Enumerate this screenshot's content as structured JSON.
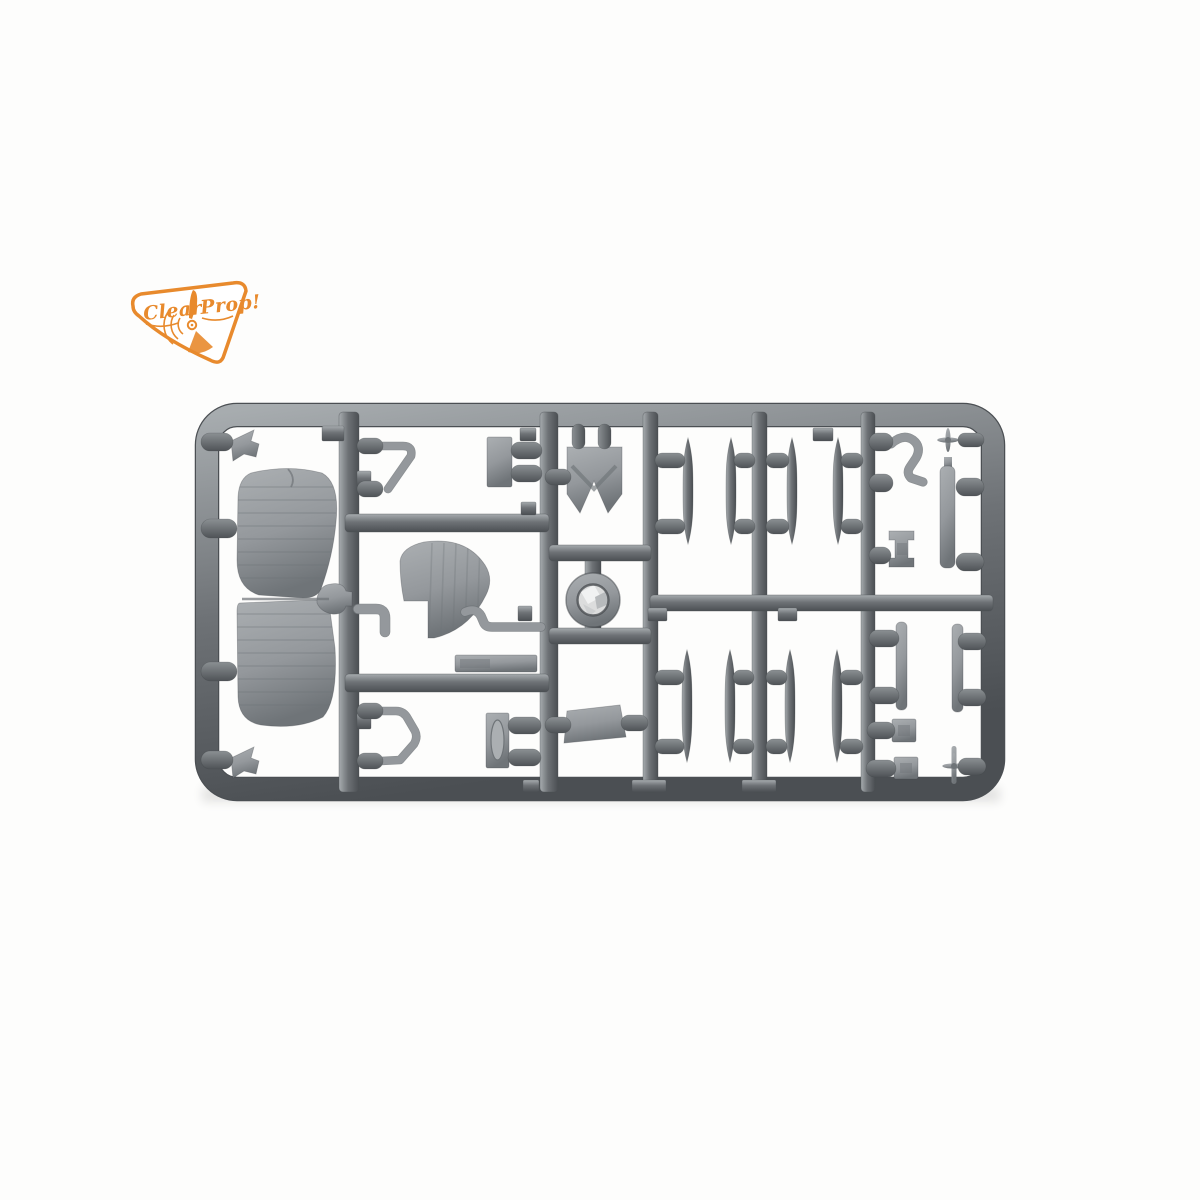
{
  "logo": {
    "brand": "Clear Prop!",
    "word1": "Clear",
    "word2": "Prop!",
    "orange": "#e88a2d"
  },
  "palette": {
    "bg": "#fdfdfc",
    "runner_hi": "#a7acaf",
    "runner_mid": "#6e7276",
    "runner_lo": "#4b4f53",
    "part_hi": "#abafb2",
    "part_mid": "#94989c",
    "part_lo": "#6f7478",
    "gate_hi": "#8b9093",
    "gate_lo": "#4f5357",
    "shine": "#dcdddd",
    "outline": "#3f4347"
  },
  "sprue": {
    "frame": {
      "x": 207,
      "y": 415,
      "w": 786,
      "h": 374,
      "r": 30,
      "t": 22
    },
    "v_runners": [
      [
        339,
        412,
        20,
        380
      ],
      [
        540,
        412,
        18,
        380
      ],
      [
        643,
        412,
        15,
        380
      ],
      [
        752,
        412,
        15,
        380
      ],
      [
        861,
        412,
        14,
        380
      ],
      [
        585,
        548,
        16,
        90
      ]
    ],
    "h_runners": [
      [
        345,
        514,
        204,
        18
      ],
      [
        345,
        674,
        204,
        18
      ],
      [
        549,
        545,
        102,
        16
      ],
      [
        549,
        628,
        102,
        16
      ],
      [
        650,
        595,
        343,
        16
      ]
    ],
    "tabs": [
      [
        322,
        426,
        22,
        15
      ],
      [
        357,
        471,
        14,
        16
      ],
      [
        520,
        428,
        16,
        13
      ],
      [
        521,
        502,
        15,
        13
      ],
      [
        813,
        428,
        20,
        13
      ],
      [
        648,
        608,
        19,
        13
      ],
      [
        778,
        608,
        19,
        13
      ],
      [
        632,
        780,
        34,
        12
      ],
      [
        742,
        780,
        34,
        12
      ],
      [
        523,
        780,
        16,
        12
      ],
      [
        357,
        713,
        14,
        16
      ],
      [
        518,
        606,
        14,
        15
      ]
    ],
    "struts": [
      [
        688,
        438,
        544
      ],
      [
        731,
        438,
        544
      ],
      [
        792,
        438,
        544
      ],
      [
        838,
        438,
        544
      ],
      [
        687,
        650,
        762
      ],
      [
        730,
        650,
        762
      ],
      [
        790,
        650,
        762
      ],
      [
        837,
        650,
        762
      ]
    ],
    "strut_half_width": 5,
    "gates": [
      [
        201,
        433,
        32,
        18
      ],
      [
        201,
        519,
        36,
        19
      ],
      [
        201,
        662,
        36,
        19
      ],
      [
        201,
        751,
        32,
        18
      ],
      [
        357,
        438,
        26,
        16
      ],
      [
        357,
        481,
        26,
        16
      ],
      [
        357,
        703,
        26,
        16
      ],
      [
        357,
        753,
        26,
        16
      ],
      [
        511,
        442,
        31,
        17
      ],
      [
        511,
        465,
        31,
        17
      ],
      [
        508,
        717,
        33,
        17
      ],
      [
        508,
        749,
        33,
        17
      ],
      [
        545,
        469,
        26,
        16
      ],
      [
        545,
        717,
        26,
        16
      ],
      [
        621,
        715,
        27,
        16
      ],
      [
        572,
        424,
        13,
        25
      ],
      [
        598,
        424,
        13,
        25
      ],
      [
        655,
        453,
        30,
        15
      ],
      [
        655,
        519,
        30,
        15
      ],
      [
        734,
        453,
        21,
        15
      ],
      [
        734,
        519,
        21,
        15
      ],
      [
        766,
        453,
        23,
        15
      ],
      [
        766,
        519,
        23,
        15
      ],
      [
        841,
        453,
        22,
        15
      ],
      [
        841,
        519,
        22,
        15
      ],
      [
        655,
        670,
        29,
        15
      ],
      [
        655,
        739,
        29,
        15
      ],
      [
        733,
        670,
        21,
        15
      ],
      [
        733,
        739,
        21,
        15
      ],
      [
        766,
        670,
        21,
        15
      ],
      [
        766,
        739,
        21,
        15
      ],
      [
        840,
        670,
        23,
        15
      ],
      [
        840,
        739,
        23,
        15
      ],
      [
        869,
        433,
        24,
        18
      ],
      [
        869,
        474,
        24,
        18
      ],
      [
        869,
        547,
        22,
        17
      ],
      [
        869,
        630,
        30,
        17
      ],
      [
        869,
        687,
        30,
        17
      ],
      [
        867,
        722,
        28,
        17
      ],
      [
        866,
        760,
        30,
        17
      ],
      [
        958,
        433,
        26,
        14
      ],
      [
        956,
        478,
        28,
        18
      ],
      [
        956,
        553,
        28,
        18
      ],
      [
        958,
        633,
        28,
        17
      ],
      [
        958,
        689,
        28,
        17
      ],
      [
        958,
        758,
        28,
        17
      ]
    ],
    "parts": [
      {
        "name": "upper-wing-part",
        "kind": "wing",
        "d": "M251,473 Q239,478 238,497 L237,560 Q237,588 259,595 L303,598 Q317,598 321,589 Q333,556 336,522 Q340,483 322,473 Q288,464 251,473 Z",
        "ribs": {
          "x1": 238,
          "x2": 336,
          "y0": 487,
          "step": 13,
          "n": 8
        },
        "crack": "M288,469 Q296,478 291,487"
      },
      {
        "name": "lower-wing-part",
        "kind": "wing",
        "d": "M240,603 L316,600 Q328,600 330,611 L335,648 Q338,700 323,717 Q298,730 261,725 Q239,721 238,697 L237,612 Q237,603 240,603 Z",
        "ribs": {
          "x1": 237,
          "x2": 336,
          "y0": 614,
          "step": 13,
          "n": 8
        }
      },
      {
        "name": "wing-joint-connector",
        "kind": "path",
        "d": "M317,598 Q320,585 331,584 Q343,582 346,591 L352,592 L352,606 L346,606 Q343,615 332,614 Q321,612 317,603 Z"
      },
      {
        "name": "wing-seam",
        "kind": "line",
        "x1": 242,
        "y1": 599,
        "x2": 329,
        "y2": 599,
        "w": 2.4,
        "opacity": 0.7
      },
      {
        "name": "pennant-part-top",
        "kind": "path",
        "d": "M231,441 L254,430 L251,441 L259,444 L256,457 L244,454 L233,461 Z"
      },
      {
        "name": "pennant-part-bottom",
        "kind": "path",
        "d": "M231,758 L254,747 L251,758 L259,761 L256,774 L244,771 L233,778 Z"
      },
      {
        "name": "windscreen-frame-part-top",
        "kind": "stroke",
        "d": "M381,446 L403,446 Q413,446 411,456 L388,489",
        "w": 7
      },
      {
        "name": "small-plate-part",
        "kind": "rect",
        "x": 487,
        "y": 437,
        "wd": 25,
        "ht": 50,
        "rx": 2
      },
      {
        "name": "tail-fin-part",
        "kind": "fin",
        "d": "M400,561 Q402,547 424,542 Q466,536 485,565 Q494,579 486,595 Q469,630 434,638 L428,638 L428,601 L404,601 Q400,581 400,561 Z",
        "ribs": {
          "x0": 432,
          "step": 12,
          "n": 5,
          "y1": 543,
          "y2": 636
        }
      },
      {
        "name": "bent-rod-part-left",
        "kind": "stroke",
        "d": "M358,609 L376,609 Q385,609 385,618 L385,632",
        "w": 9
      },
      {
        "name": "bent-rod-part-right",
        "kind": "stroke",
        "d": "M465,612 Q476,607 481,616 L484,623 Q486,627 492,627 L541,627",
        "w": 8
      },
      {
        "name": "strip-part-a",
        "kind": "rect",
        "x": 455,
        "y": 655,
        "wd": 82,
        "ht": 17,
        "rx": 2,
        "inner": [
          460,
          659,
          30,
          9
        ]
      },
      {
        "name": "windscreen-frame-part-bottom",
        "kind": "stroke",
        "d": "M381,711 L396,711 Q404,711 408,719 L415,731 Q418,737 414,744 L400,760 L381,761",
        "w": 7
      },
      {
        "name": "headrest-plate-part",
        "kind": "rect",
        "x": 486,
        "y": 713,
        "wd": 23,
        "ht": 55,
        "rx": 2,
        "oval": [
          497.5,
          740,
          6.5,
          20
        ]
      },
      {
        "name": "fuselage-deck-part",
        "kind": "path",
        "d": "M567,447 L622,447 L622,494 L608,513 L594,481 L580,513 L567,494 Z",
        "chevron": "M572,466 L594,489 L616,466"
      },
      {
        "name": "cowl-ring-part",
        "kind": "ring",
        "cx": 593,
        "cy": 600,
        "ro": 27,
        "ri": 15.5,
        "facets": [
          {
            "pts": "581,592 594,585 601,597 588,604",
            "c": "#f1f2f2"
          },
          {
            "pts": "595,597 607,591 609,604 597,609",
            "c": "#b7babc"
          },
          {
            "pts": "583,604 596,611 589,616",
            "c": "#cdcfd0"
          }
        ]
      },
      {
        "name": "cone-part",
        "kind": "path",
        "d": "M567,711 L620,705 L626,737 L564,743 Z"
      },
      {
        "name": "exhaust-pipe-part",
        "kind": "stroke",
        "d": "M891,444 Q903,433 913,440 Q922,447 916,458 L910,467 Q906,473 911,478 L923,482",
        "w": 7.5
      },
      {
        "name": "mini-propeller-part-top",
        "kind": "prop",
        "cx": 948,
        "cy": 440,
        "r": 12
      },
      {
        "name": "long-strip-part",
        "kind": "rect",
        "x": 940,
        "y": 466,
        "wd": 15,
        "ht": 102,
        "rx": 6,
        "tab": [
          944,
          457,
          8,
          11
        ]
      },
      {
        "name": "bracket-part",
        "kind": "path",
        "d": "M889,531 L914,531 L914,540 L908,540 L908,558 L914,558 L914,567 L889,567 L889,558 L895,558 L895,540 L889,540 Z",
        "inner": [
          897,
          543,
          10,
          12
        ]
      },
      {
        "name": "strip-part-b",
        "kind": "rect",
        "x": 896,
        "y": 622,
        "wd": 11,
        "ht": 88,
        "rx": 5
      },
      {
        "name": "strip-part-c",
        "kind": "rect",
        "x": 952,
        "y": 624,
        "wd": 11,
        "ht": 88,
        "rx": 5
      },
      {
        "name": "square-part-a",
        "kind": "rect",
        "x": 892,
        "y": 719,
        "wd": 24,
        "ht": 23,
        "rx": 2,
        "inner": [
          898,
          725,
          12,
          11
        ]
      },
      {
        "name": "square-part-b",
        "kind": "rect",
        "x": 894,
        "y": 757,
        "wd": 24,
        "ht": 22,
        "rx": 2,
        "inner": [
          900,
          763,
          12,
          10
        ]
      },
      {
        "name": "mini-propeller-part-bottom",
        "kind": "prop",
        "cx": 954,
        "cy": 766,
        "r": 13,
        "pin": [
          951.5,
          746,
          5,
          38
        ]
      }
    ]
  }
}
